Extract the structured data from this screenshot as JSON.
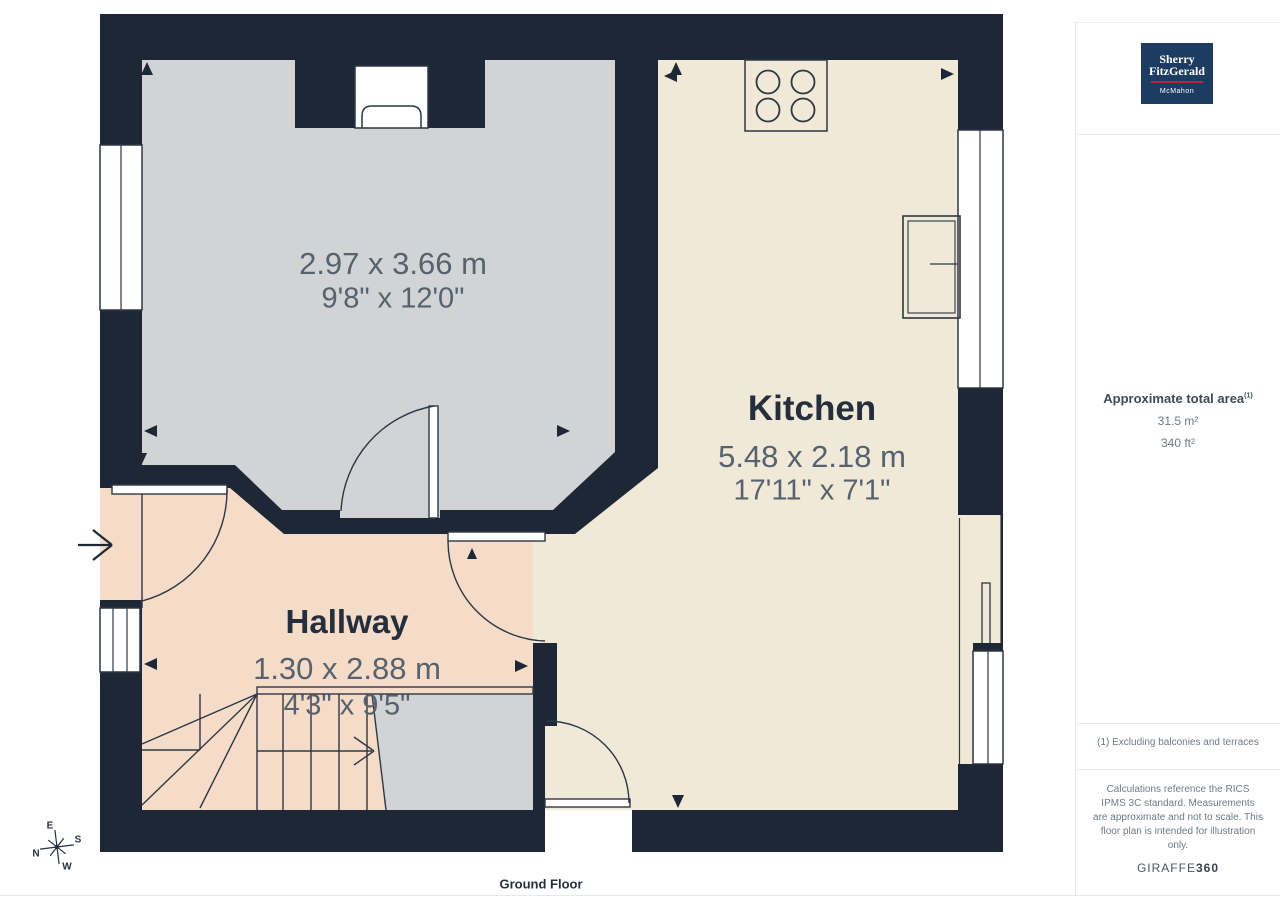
{
  "floor_plan": {
    "floor_label": "Ground Floor",
    "rooms": {
      "living": {
        "dim_metric": "2.97 x 3.66 m",
        "dim_imperial": "9'8\" x 12'0\""
      },
      "kitchen": {
        "name": "Kitchen",
        "dim_metric": "5.48 x 2.18 m",
        "dim_imperial": "17'11\" x 7'1\""
      },
      "hallway": {
        "name": "Hallway",
        "dim_metric": "1.30 x 2.88 m",
        "dim_imperial": "4'3\" x 9'5\""
      }
    },
    "compass": {
      "n": "N",
      "e": "E",
      "s": "S",
      "w": "W"
    }
  },
  "sidebar": {
    "logo": {
      "line1": "Sherry",
      "line2": "FitzGerald",
      "line3": "McMahon"
    },
    "area": {
      "title": "Approximate total area",
      "footnote_marker": "(1)",
      "metric_value": "31.5 m²",
      "imperial_value": "340 ft²"
    },
    "footnote": "(1) Excluding balconies and terraces",
    "disclaimer": "Calculations reference the RICS IPMS 3C standard. Measurements are approximate and not to scale. This floor plan is intended for illustration only.",
    "brand": {
      "name": "GIRAFFE",
      "suffix": "360"
    }
  },
  "colors": {
    "wall": "#1d2736",
    "living_floor": "#d2d3d5",
    "kitchen_floor": "#f0e9d7",
    "hallway_floor": "#f5dcc9",
    "logo_background": "#1d3c61",
    "logo_underline": "#c22033",
    "room_name_text": "#242e3d",
    "dimension_text": "#57626f"
  }
}
